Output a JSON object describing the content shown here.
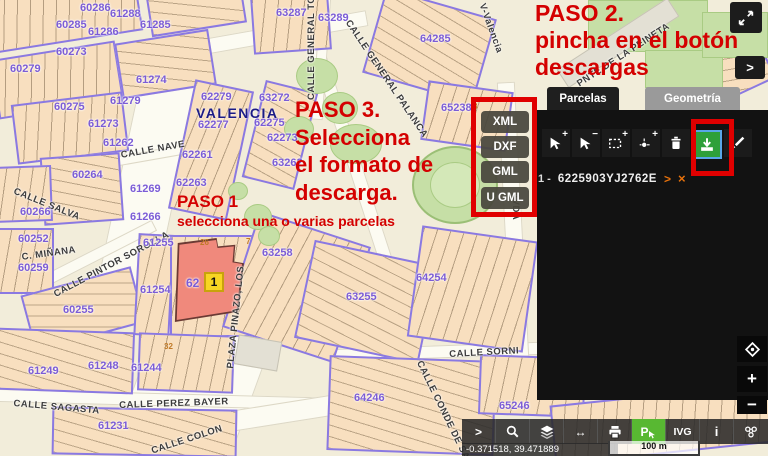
{
  "annotations": {
    "color": "#d40000",
    "paso1_title": "PASO 1",
    "paso1_subtitle": "selecciona una o varias parcelas",
    "paso2_line1": "PASO 2.",
    "paso2_line2": "pincha en el botón",
    "paso2_line3": "descargas",
    "paso3_line1": "PASO 3.",
    "paso3_line2": "Selecciona",
    "paso3_line3": "el formato de",
    "paso3_line4": "descarga."
  },
  "download_menu": {
    "options": [
      "XML",
      "DXF",
      "GML",
      "U GML"
    ]
  },
  "side_panel": {
    "tabs": [
      {
        "label": "Parcelas",
        "active": true
      },
      {
        "label": "Geometría",
        "active": false
      }
    ],
    "toolbar_icons": [
      "add-parcel-pointer",
      "remove-parcel-pointer",
      "add-rectangle-selection",
      "add-point-selection",
      "clear-selection-trash",
      "download-parcels",
      "edit-parcel"
    ],
    "download_button_color": "#2ea03a",
    "parcel_list": [
      {
        "index": "1 -",
        "reference": "6225903YJ2762E",
        "expand_icon": ">",
        "delete_icon": "×"
      }
    ]
  },
  "map": {
    "city_label": "VALENCIA",
    "selected_parcel_block": "62",
    "selected_parcel_marker": "1",
    "street_labels": [
      {
        "text": "CALLE GENERAL TOVA",
        "x": 306,
        "y": 100,
        "rot": -90
      },
      {
        "text": "CALLE GENERAL PALANCA",
        "x": 352,
        "y": 18,
        "rot": 56
      },
      {
        "text": "V-Valencia",
        "x": 487,
        "y": 2,
        "rot": 70
      },
      {
        "text": "PNTE DE LA PEINETA",
        "x": 575,
        "y": 80,
        "rot": -33
      },
      {
        "text": "CALLE NAVE",
        "x": 120,
        "y": 150,
        "rot": -10
      },
      {
        "text": "CALLE SALVA",
        "x": 16,
        "y": 186,
        "rot": 22
      },
      {
        "text": "C. MIÑANA",
        "x": 21,
        "y": 252,
        "rot": -8
      },
      {
        "text": "CALLE PINTOR SOROLLA",
        "x": 52,
        "y": 290,
        "rot": -28
      },
      {
        "text": "PLAZA PINAZO, LOS",
        "x": 225,
        "y": 368,
        "rot": -84
      },
      {
        "text": "CALLE SAGASTA",
        "x": 14,
        "y": 398,
        "rot": 5
      },
      {
        "text": "CALLE PEREZ BAYER",
        "x": 119,
        "y": 400,
        "rot": -2
      },
      {
        "text": "CALLE COLON",
        "x": 150,
        "y": 446,
        "rot": -18
      },
      {
        "text": "CALLE SORNI",
        "x": 449,
        "y": 349,
        "rot": -3
      },
      {
        "text": "CALLE CONDE DE SAL",
        "x": 424,
        "y": 359,
        "rot": 64
      },
      {
        "text": "AVDA",
        "x": 521,
        "y": 192,
        "rot": 90
      }
    ],
    "block_labels": [
      {
        "text": "60286",
        "x": 80,
        "y": 2
      },
      {
        "text": "61288",
        "x": 110,
        "y": 8
      },
      {
        "text": "60285",
        "x": 56,
        "y": 19
      },
      {
        "text": "61286",
        "x": 88,
        "y": 26
      },
      {
        "text": "61285",
        "x": 140,
        "y": 19
      },
      {
        "text": "63287",
        "x": 276,
        "y": 7
      },
      {
        "text": "63289",
        "x": 318,
        "y": 12
      },
      {
        "text": "64285",
        "x": 420,
        "y": 33
      },
      {
        "text": "60273",
        "x": 56,
        "y": 46
      },
      {
        "text": "60279",
        "x": 10,
        "y": 63
      },
      {
        "text": "61274",
        "x": 136,
        "y": 74
      },
      {
        "text": "61279",
        "x": 110,
        "y": 95
      },
      {
        "text": "60275",
        "x": 54,
        "y": 101
      },
      {
        "text": "61273",
        "x": 88,
        "y": 118
      },
      {
        "text": "61262",
        "x": 103,
        "y": 137
      },
      {
        "text": "60264",
        "x": 72,
        "y": 169
      },
      {
        "text": "61269",
        "x": 130,
        "y": 183
      },
      {
        "text": "60266",
        "x": 20,
        "y": 206
      },
      {
        "text": "61266",
        "x": 130,
        "y": 211
      },
      {
        "text": "60252",
        "x": 18,
        "y": 233
      },
      {
        "text": "60259",
        "x": 18,
        "y": 262
      },
      {
        "text": "60255",
        "x": 63,
        "y": 304
      },
      {
        "text": "61255",
        "x": 143,
        "y": 237
      },
      {
        "text": "61254",
        "x": 140,
        "y": 284
      },
      {
        "text": "62279",
        "x": 201,
        "y": 91
      },
      {
        "text": "63272",
        "x": 259,
        "y": 92
      },
      {
        "text": "62277",
        "x": 198,
        "y": 119
      },
      {
        "text": "62275",
        "x": 254,
        "y": 117
      },
      {
        "text": "62273",
        "x": 267,
        "y": 132
      },
      {
        "text": "63262",
        "x": 272,
        "y": 157
      },
      {
        "text": "62261",
        "x": 182,
        "y": 149
      },
      {
        "text": "62263",
        "x": 176,
        "y": 177
      },
      {
        "text": "65238",
        "x": 441,
        "y": 102
      },
      {
        "text": "63258",
        "x": 262,
        "y": 247
      },
      {
        "text": "63255",
        "x": 346,
        "y": 291
      },
      {
        "text": "64254",
        "x": 416,
        "y": 272
      },
      {
        "text": "61249",
        "x": 28,
        "y": 365
      },
      {
        "text": "61248",
        "x": 88,
        "y": 360
      },
      {
        "text": "61244",
        "x": 131,
        "y": 362
      },
      {
        "text": "61231",
        "x": 98,
        "y": 420
      },
      {
        "text": "64246",
        "x": 354,
        "y": 392
      },
      {
        "text": "65246",
        "x": 499,
        "y": 400
      }
    ],
    "house_numbers": [
      {
        "text": "26",
        "x": 200,
        "y": 238
      },
      {
        "text": "7",
        "x": 246,
        "y": 237
      },
      {
        "text": "32",
        "x": 164,
        "y": 342
      },
      {
        "text": "8",
        "x": 473,
        "y": 102
      }
    ]
  },
  "corner_controls": {
    "panel_toggle": ">",
    "zoom_in": "+",
    "zoom_out": "−"
  },
  "bottom_bar": {
    "expand_label": ">",
    "ivg_label": "IVG",
    "info_label": "i",
    "pin_label": "P",
    "coordinates": "-0.371518, 39.471889",
    "scale_label": "100 m"
  }
}
